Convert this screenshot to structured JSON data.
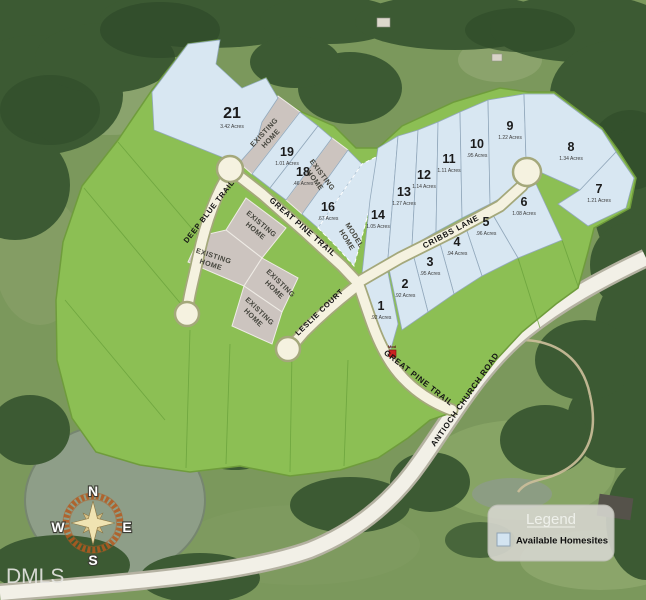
{
  "watermark": "DMLS",
  "legend": {
    "title": "Legend",
    "items": [
      {
        "label": "Available Homesites",
        "swatch_color": "#d3e4f1"
      }
    ]
  },
  "compass": {
    "n": "N",
    "e": "E",
    "s": "S",
    "w": "W"
  },
  "roads": {
    "deep_blue_trail": "DEEP BLUE TRAIL",
    "great_pine_trail": "GREAT PINE TRAIL",
    "cribbs_lane": "CRIBBS LANE",
    "leslie_court": "LESLIE COURT",
    "antioch_church_road": "ANTIOCH CHURCH ROAD"
  },
  "labels": {
    "existing_home": {
      "line1": "EXISTING",
      "line2": "HOME"
    },
    "model_home": {
      "line1": "MODEL",
      "line2": "HOME"
    }
  },
  "entrance_marker": {
    "label": "Mod"
  },
  "lots": [
    {
      "number": "1",
      "acreage": ".92 Acres"
    },
    {
      "number": "2",
      "acreage": ".92 Acres"
    },
    {
      "number": "3",
      "acreage": ".95 Acres"
    },
    {
      "number": "4",
      "acreage": ".94 Acres"
    },
    {
      "number": "5",
      "acreage": ".96 Acres"
    },
    {
      "number": "6",
      "acreage": "1.08 Acres"
    },
    {
      "number": "7",
      "acreage": "1.21 Acres"
    },
    {
      "number": "8",
      "acreage": "1.34 Acres"
    },
    {
      "number": "9",
      "acreage": "1.22 Acres"
    },
    {
      "number": "10",
      "acreage": ".95 Acres"
    },
    {
      "number": "11",
      "acreage": "1.11 Acres"
    },
    {
      "number": "12",
      "acreage": "1.14 Acres"
    },
    {
      "number": "13",
      "acreage": "1.27 Acres"
    },
    {
      "number": "14",
      "acreage": "1.05 Acres"
    },
    {
      "number": "16",
      "acreage": ".67 Acres"
    },
    {
      "number": "18",
      "acreage": ".46 Acres"
    },
    {
      "number": "19",
      "acreage": "1.01 Acres"
    },
    {
      "number": "21",
      "acreage": "3.42 Acres"
    }
  ],
  "colors": {
    "available_fill": "#d8e7f2",
    "sold_green": "#8cbf54",
    "existing_gray": "#ccc4bf",
    "road_fill": "#f5f2e0",
    "forest": "#3c5a33"
  }
}
